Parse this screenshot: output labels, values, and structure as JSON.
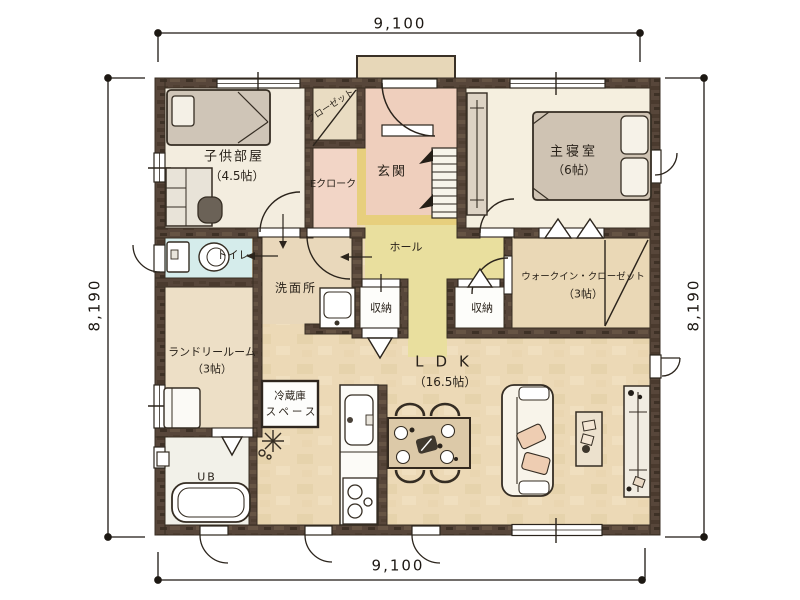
{
  "plan_title": "1F floor plan",
  "dimensions": {
    "top": "9,100",
    "bottom": "9,100",
    "left": "8,190",
    "right": "8,190"
  },
  "rooms": {
    "kids": {
      "name": "子供部屋",
      "size": "（4.5帖）"
    },
    "closet": {
      "name": "クローゼット"
    },
    "entrance_cloak": {
      "name": "Eクローク"
    },
    "entrance": {
      "name": "玄関"
    },
    "master": {
      "name": "主寝室",
      "size": "（6帖）"
    },
    "toilet": {
      "name": "トイレ"
    },
    "washroom": {
      "name": "洗面所"
    },
    "hall": {
      "name": "ホール"
    },
    "storage1": {
      "name": "収納"
    },
    "storage2": {
      "name": "収納"
    },
    "wic": {
      "name": "ウォークイン・クローゼット",
      "size": "（3帖）"
    },
    "laundry": {
      "name": "ランドリールーム",
      "size": "（3帖）"
    },
    "fridge": {
      "line1": "冷蔵庫",
      "line2": "スペース"
    },
    "bath": {
      "name": "UB"
    },
    "ldk": {
      "name": "LDK",
      "size": "（16.5帖）"
    }
  },
  "colors": {
    "wall": "#57463a",
    "wall_dark": "#463729",
    "floor_main": "#ecd9b6",
    "floor_bedroom": "#f5efdf",
    "floor_entrance": "#efcfbd",
    "floor_hall": "#e9df9e",
    "floor_step": "#e7cf7d",
    "floor_toilet": "#d5eceb",
    "floor_washroom": "#e9d8bb",
    "floor_laundry": "#eddfc6",
    "floor_bath": "#f2f1e9",
    "floor_closet_white": "#fdfdfa",
    "line": "#2b241c"
  }
}
